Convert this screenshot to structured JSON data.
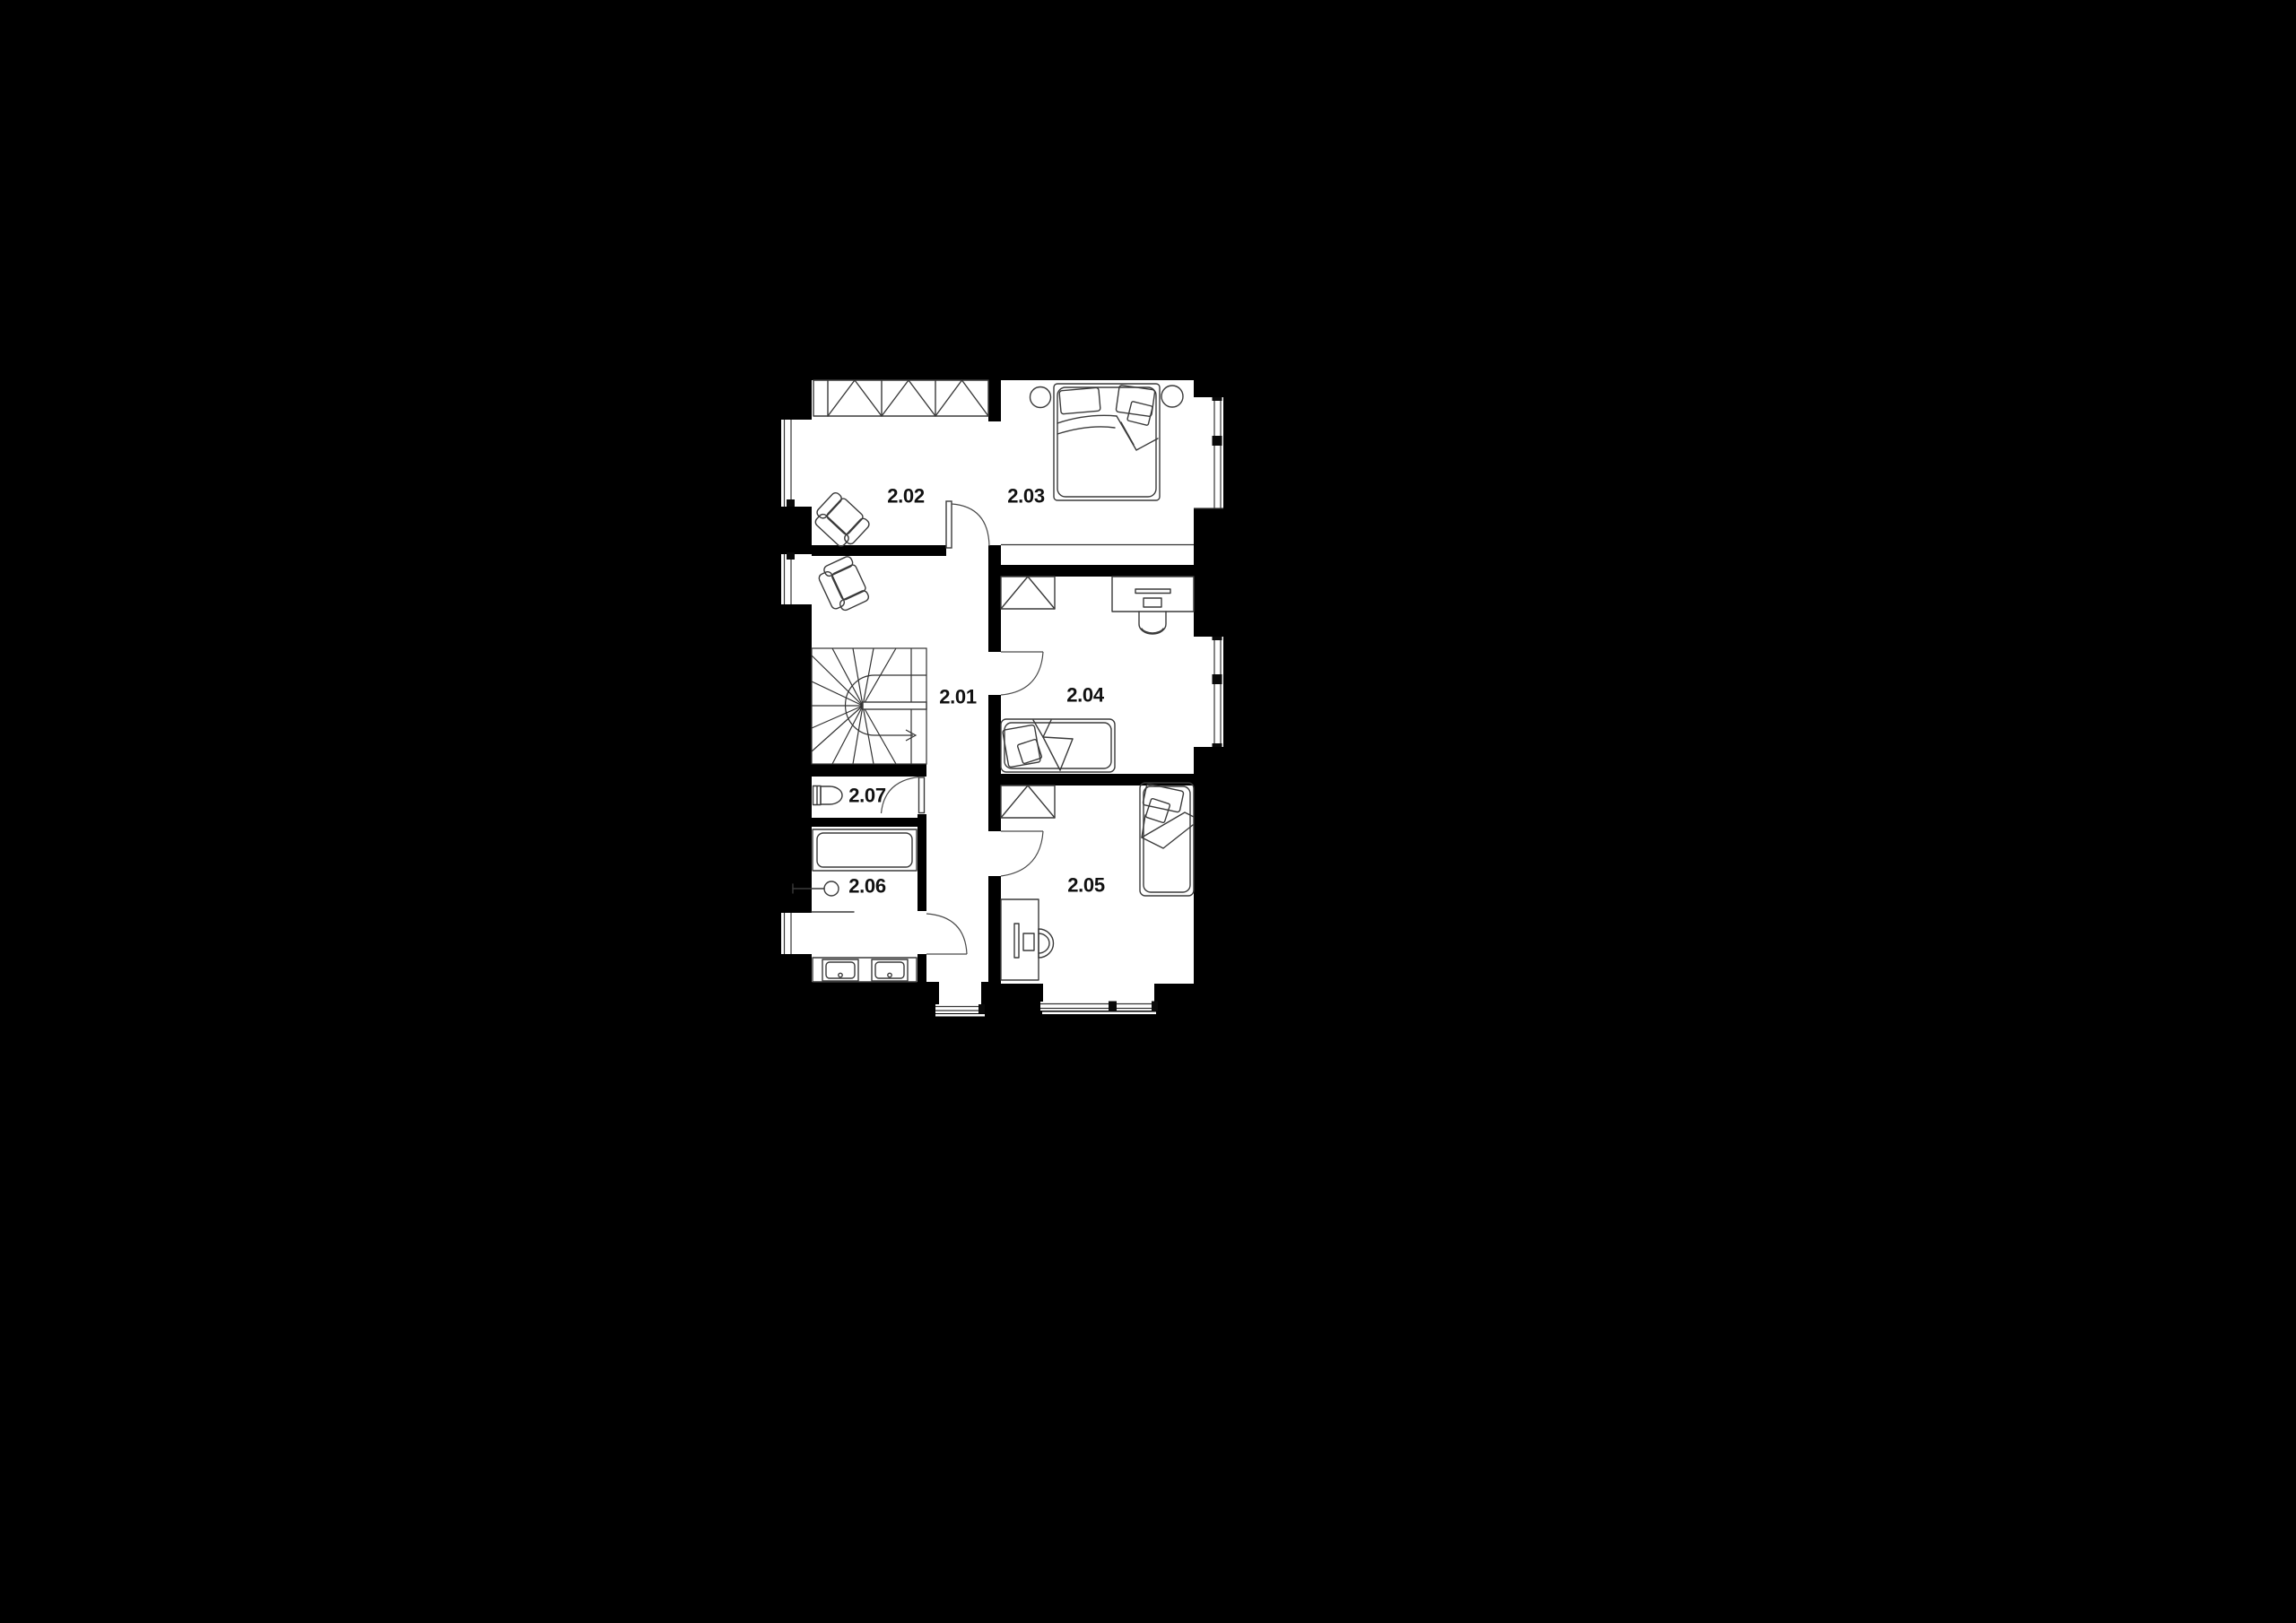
{
  "canvas": {
    "background": "#000000",
    "floor": "#ffffff",
    "wall": "#000000",
    "furniture_line": "#3a3a3a",
    "label_color": "#111111"
  },
  "floorplan": {
    "rooms": [
      {
        "label": "2.01",
        "furniture": [
          "armchair",
          "winder-staircase",
          "entry-door"
        ]
      },
      {
        "label": "2.02",
        "furniture": [
          "wardrobe",
          "armchair",
          "door"
        ]
      },
      {
        "label": "2.03",
        "furniture": [
          "double-bed",
          "nightstand",
          "nightstand",
          "window"
        ]
      },
      {
        "label": "2.04",
        "furniture": [
          "wardrobe",
          "desk",
          "chair",
          "single-bed",
          "door",
          "window"
        ]
      },
      {
        "label": "2.05",
        "furniture": [
          "wardrobe",
          "single-bed",
          "desk",
          "chair",
          "door",
          "window"
        ]
      },
      {
        "label": "2.06",
        "furniture": [
          "bathtub",
          "shower-mixer",
          "double-sink",
          "window"
        ]
      },
      {
        "label": "2.07",
        "furniture": [
          "toilet",
          "door"
        ]
      }
    ]
  }
}
